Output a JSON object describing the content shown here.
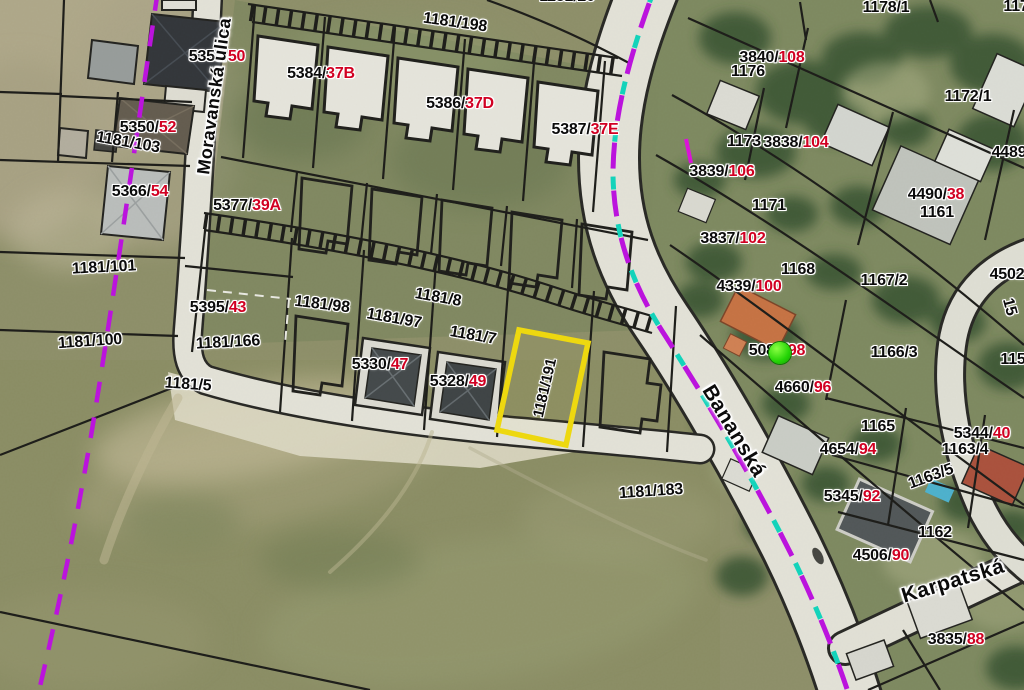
{
  "map": {
    "highlighted_parcel": "1181/191",
    "colors": {
      "parcel_line": "#0d0d0d",
      "house_number_red": "#d10022",
      "highlight_outline": "#ffe600",
      "boundary_dashed_purple": "#c400f0",
      "utility_dashed_cyan": "#00e0c8",
      "marker_green": "#2bd60a",
      "road_fill": "#f1f0e8"
    },
    "streets": [
      {
        "name": "Moravanská ulica",
        "x": 214,
        "y": 96,
        "rot": -82,
        "fs": 18
      },
      {
        "name": "Bananská",
        "x": 734,
        "y": 431,
        "rot": 59,
        "fs": 21
      },
      {
        "name": "Karpatská",
        "x": 953,
        "y": 581,
        "rot": -17,
        "fs": 21
      }
    ],
    "labels": [
      {
        "black": "5356/",
        "red": "50",
        "x": 217,
        "y": 57
      },
      {
        "black": "5350/",
        "red": "52",
        "x": 148,
        "y": 128
      },
      {
        "black": "5366/",
        "red": "54",
        "x": 140,
        "y": 192
      },
      {
        "black": "5377/",
        "red": "39A",
        "x": 247,
        "y": 206
      },
      {
        "black": "5384/",
        "red": "37B",
        "x": 321,
        "y": 74
      },
      {
        "black": "5386/",
        "red": "37D",
        "x": 460,
        "y": 104
      },
      {
        "black": "5387/",
        "red": "37E",
        "x": 585,
        "y": 130
      },
      {
        "black": "5395/",
        "red": "43",
        "x": 218,
        "y": 308
      },
      {
        "black": "5330/",
        "red": "47",
        "x": 380,
        "y": 365
      },
      {
        "black": "5328/",
        "red": "49",
        "x": 458,
        "y": 382
      },
      {
        "black": "3840/",
        "red": "108",
        "x": 772,
        "y": 58
      },
      {
        "black": "1173",
        "x": 744,
        "y": 142
      },
      {
        "black": "3838/",
        "red": "104",
        "x": 796,
        "y": 143
      },
      {
        "black": "3839/",
        "red": "106",
        "x": 722,
        "y": 172
      },
      {
        "black": "4490/",
        "red": "38",
        "x": 936,
        "y": 195
      },
      {
        "black": "1161",
        "x": 937,
        "y": 213
      },
      {
        "black": "3837/",
        "red": "102",
        "x": 733,
        "y": 239
      },
      {
        "black": "4339/",
        "red": "100",
        "x": 749,
        "y": 287
      },
      {
        "black": "5087/",
        "red": "98",
        "x": 777,
        "y": 351
      },
      {
        "black": "4660/",
        "red": "96",
        "x": 803,
        "y": 388
      },
      {
        "black": "5344/",
        "red": "40",
        "x": 982,
        "y": 434
      },
      {
        "black": "4654/",
        "red": "94",
        "x": 848,
        "y": 450
      },
      {
        "black": "5345/",
        "red": "92",
        "x": 852,
        "y": 497
      },
      {
        "black": "4506/",
        "red": "90",
        "x": 881,
        "y": 556
      },
      {
        "black": "3835/",
        "red": "88",
        "x": 956,
        "y": 640
      },
      {
        "black": "1181/198",
        "x": 455,
        "y": 23,
        "rot": 8
      },
      {
        "black": "1181/20",
        "x": 567,
        "y": -3
      },
      {
        "black": "1178/1",
        "x": 886,
        "y": 8
      },
      {
        "black": "117",
        "x": 1016,
        "y": 7
      },
      {
        "black": "1172/1",
        "x": 968,
        "y": 97
      },
      {
        "black": "1176",
        "x": 748,
        "y": 72
      },
      {
        "black": "1171",
        "x": 769,
        "y": 206
      },
      {
        "black": "4489",
        "x": 1009,
        "y": 153
      },
      {
        "black": "1167/2",
        "x": 884,
        "y": 281
      },
      {
        "black": "1168",
        "x": 798,
        "y": 270
      },
      {
        "black": "4502",
        "x": 1007,
        "y": 275
      },
      {
        "black": "15",
        "x": 1009,
        "y": 307,
        "rot": 75
      },
      {
        "black": "115",
        "x": 1013,
        "y": 360
      },
      {
        "black": "1166/3",
        "x": 894,
        "y": 353
      },
      {
        "black": "1165",
        "x": 878,
        "y": 427
      },
      {
        "black": "1163/4",
        "x": 965,
        "y": 450
      },
      {
        "black": "1163/5",
        "x": 931,
        "y": 477,
        "rot": -20
      },
      {
        "black": "1162",
        "x": 935,
        "y": 533
      },
      {
        "black": "1181/101",
        "x": 104,
        "y": 268,
        "rot": -3
      },
      {
        "black": "1181/100",
        "x": 90,
        "y": 342,
        "rot": -4
      },
      {
        "black": "1181/103",
        "x": 128,
        "y": 143,
        "rot": 10
      },
      {
        "black": "1181/166",
        "x": 228,
        "y": 343,
        "rot": -3
      },
      {
        "black": "1181/5",
        "x": 188,
        "y": 385,
        "rot": 4
      },
      {
        "black": "1181/98",
        "x": 322,
        "y": 305,
        "rot": 7
      },
      {
        "black": "1181/97",
        "x": 394,
        "y": 319,
        "rot": 10
      },
      {
        "black": "1181/8",
        "x": 438,
        "y": 298,
        "rot": 10
      },
      {
        "black": "1181/7",
        "x": 473,
        "y": 336,
        "rot": 10
      },
      {
        "black": "1181/191",
        "x": 545,
        "y": 388,
        "rot": -77,
        "fs": 15
      },
      {
        "black": "1181/183",
        "x": 651,
        "y": 492,
        "rot": -4
      }
    ],
    "markers": [
      {
        "type": "green-dot",
        "x": 780,
        "y": 353,
        "r": 11
      }
    ]
  }
}
